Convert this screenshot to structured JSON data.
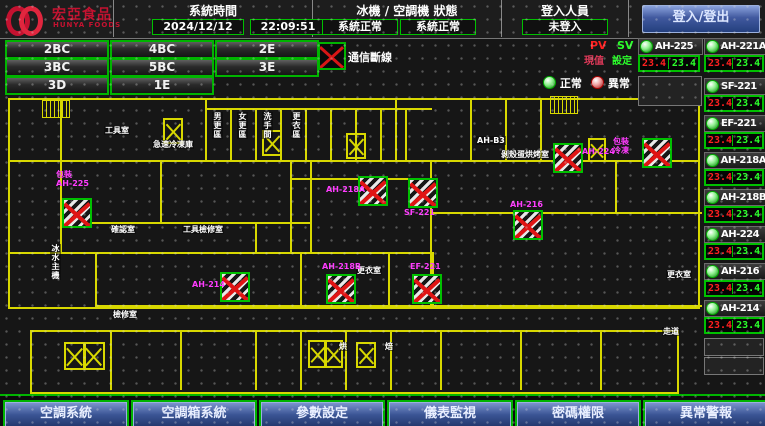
{
  "header": {
    "logo": {
      "title": "宏亞食品",
      "subtitle": "HUNYA FOODS"
    },
    "system_time": {
      "label": "系統時間",
      "date": "2024/12/12",
      "time": "22:09:51"
    },
    "machine_status": {
      "label": "冰機 / 空調機 狀態",
      "chiller": "系統正常",
      "ahu": "系統正常"
    },
    "login": {
      "label": "登入人員",
      "status": "未登入",
      "button_label": "登入/登出"
    }
  },
  "zone_buttons": [
    "2BC",
    "4BC",
    "2E",
    "3BC",
    "5BC",
    "3E",
    "3D",
    "1E"
  ],
  "legend": {
    "comm_loss": "通信斷線",
    "normal": "正常",
    "abnormal": "異常",
    "pv": "PV",
    "sv": "SV",
    "pv_caption": "現值",
    "sv_caption": "設定"
  },
  "units": [
    {
      "name": "AH-225",
      "pv": "23.4",
      "sv": "23.4"
    },
    {
      "name": "AH-221A",
      "pv": "23.4",
      "sv": "23.4"
    },
    {
      "name": "SF-221",
      "pv": "23.4",
      "sv": "23.4"
    },
    {
      "name": "EF-221",
      "pv": "23.4",
      "sv": "23.4"
    },
    {
      "name": "AH-218A",
      "pv": "23.4",
      "sv": "23.4"
    },
    {
      "name": "AH-218B",
      "pv": "23.4",
      "sv": "23.4"
    },
    {
      "name": "AH-224",
      "pv": "23.4",
      "sv": "23.4"
    },
    {
      "name": "AH-216",
      "pv": "23.4",
      "sv": "23.4"
    },
    {
      "name": "AH-214",
      "pv": "23.4",
      "sv": "23.4"
    }
  ],
  "floor_plan": {
    "devices": [
      {
        "lines": [
          "包裝",
          "AH-225"
        ],
        "x": 62,
        "y": 198,
        "lx": 56,
        "ly": 170
      },
      {
        "lines": [
          "AH-214"
        ],
        "x": 220,
        "y": 272,
        "lx": 192,
        "ly": 280
      },
      {
        "lines": [
          "AH-218B"
        ],
        "x": 326,
        "y": 274,
        "lx": 322,
        "ly": 262
      },
      {
        "lines": [
          "EF-221"
        ],
        "x": 412,
        "y": 274,
        "lx": 410,
        "ly": 262
      },
      {
        "lines": [
          "AH-218A"
        ],
        "x": 358,
        "y": 176,
        "lx": 326,
        "ly": 185
      },
      {
        "lines": [
          "SF-221"
        ],
        "x": 408,
        "y": 178,
        "lx": 404,
        "ly": 208
      },
      {
        "lines": [
          "AH-224"
        ],
        "x": 553,
        "y": 143,
        "lx": 582,
        "ly": 147
      },
      {
        "lines": [
          "包裝",
          "冷凍"
        ],
        "x": 642,
        "y": 138,
        "lx": 613,
        "ly": 137
      },
      {
        "lines": [
          "AH-216"
        ],
        "x": 513,
        "y": 210,
        "lx": 510,
        "ly": 200
      }
    ],
    "rooms": [
      {
        "text": "工具室",
        "x": 104,
        "y": 126
      },
      {
        "text": "急速冷凍庫",
        "x": 152,
        "y": 140
      },
      {
        "text": "男更區",
        "x": 212,
        "y": 112,
        "v": true
      },
      {
        "text": "女更區",
        "x": 237,
        "y": 112,
        "v": true
      },
      {
        "text": "洗手間",
        "x": 262,
        "y": 112,
        "v": true
      },
      {
        "text": "更衣區",
        "x": 291,
        "y": 112,
        "v": true
      },
      {
        "text": "AH-B3",
        "x": 476,
        "y": 136
      },
      {
        "text": "剝殼蛋烘烤室",
        "x": 500,
        "y": 150
      },
      {
        "text": "確認室",
        "x": 110,
        "y": 225
      },
      {
        "text": "工具檢修室",
        "x": 182,
        "y": 225
      },
      {
        "text": "更衣室",
        "x": 356,
        "y": 266
      },
      {
        "text": "冰水主機",
        "x": 50,
        "y": 244,
        "v": true
      },
      {
        "text": "檢修室",
        "x": 112,
        "y": 310
      },
      {
        "text": "更衣室",
        "x": 666,
        "y": 270
      },
      {
        "text": "走道",
        "x": 662,
        "y": 327
      },
      {
        "text": "烘",
        "x": 338,
        "y": 342
      },
      {
        "text": "焙",
        "x": 384,
        "y": 342
      }
    ]
  },
  "nav_buttons": [
    "空調系統",
    "空調箱系統",
    "參數設定",
    "儀表監視",
    "密碼權限",
    "異常警報"
  ],
  "colors": {
    "accent_green": "#00c000",
    "alarm_red": "#dd2222",
    "wall_yellow": "#d8d800",
    "label_magenta": "#ff3cff",
    "nav_blue": "#3a5494"
  }
}
